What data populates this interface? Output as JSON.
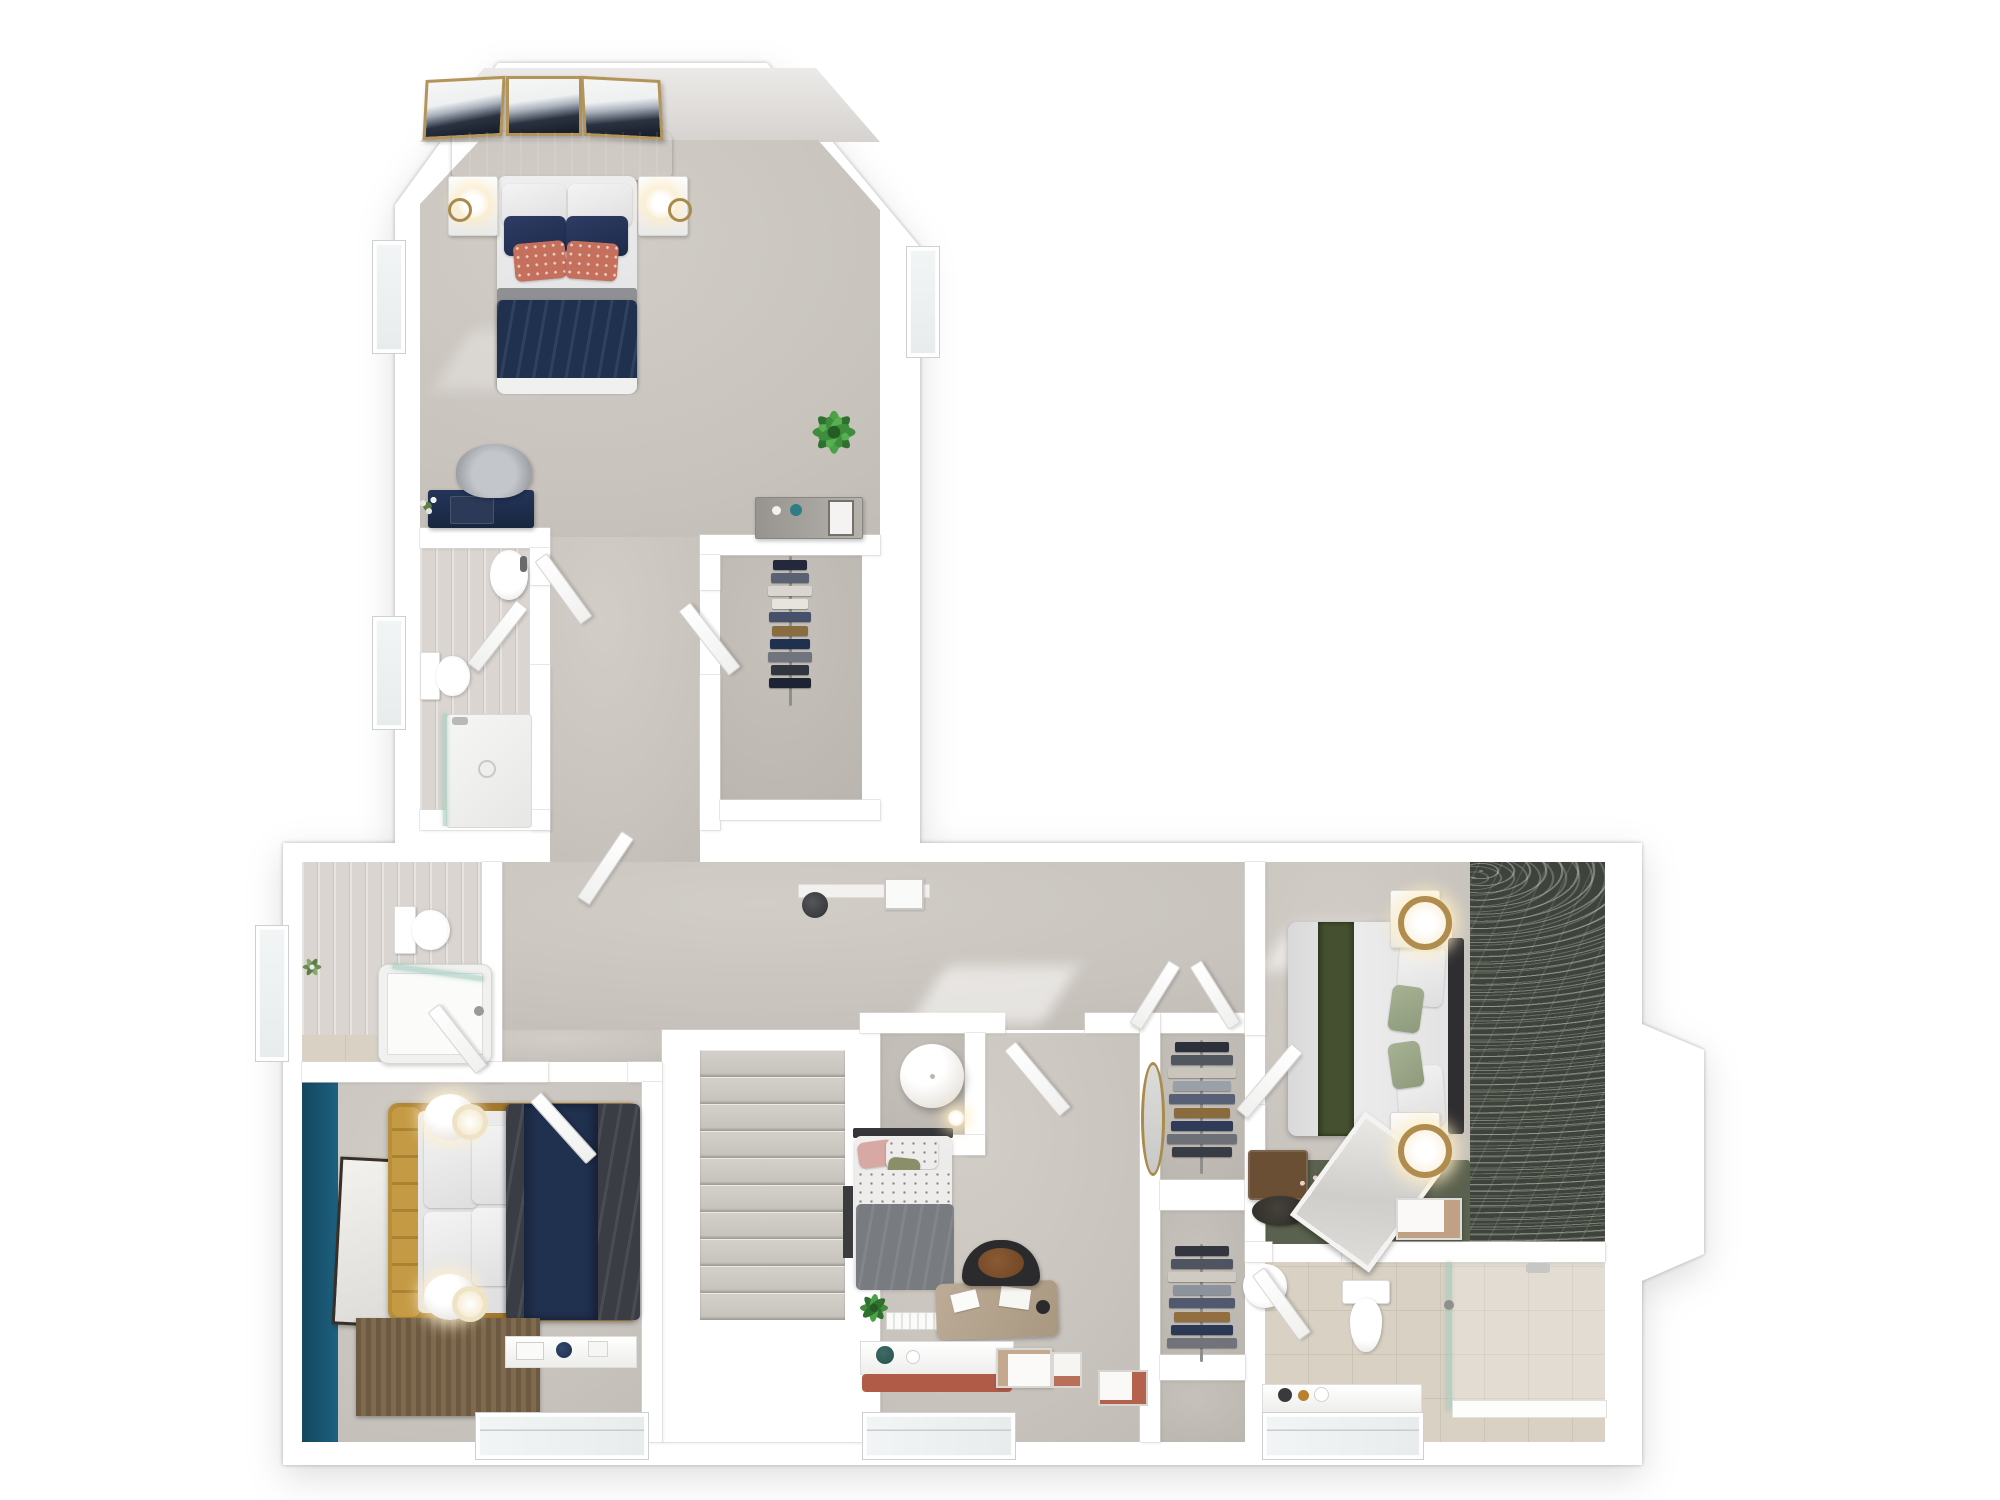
{
  "scene": {
    "type": "3d-floorplan-render",
    "view": "top-down dollhouse",
    "background": "#ffffff",
    "rooms": [
      {
        "id": "master-bedroom",
        "features": [
          "double-bed",
          "three-wall-art-frames",
          "two-nightstands",
          "desk",
          "dresser",
          "houseplant"
        ]
      },
      {
        "id": "master-ensuite",
        "features": [
          "basin",
          "toilet",
          "walk-in-shower",
          "window"
        ]
      },
      {
        "id": "walk-in-wardrobe",
        "features": [
          "clothes-rail"
        ]
      },
      {
        "id": "landing",
        "features": [
          "staircase",
          "radiator",
          "shelf"
        ]
      },
      {
        "id": "family-bathroom",
        "features": [
          "toilet",
          "bathtub",
          "window",
          "plant"
        ]
      },
      {
        "id": "bedroom-teal",
        "features": [
          "double-bed-gold-frame",
          "accent-wall",
          "artwork",
          "two-pendant-lamps",
          "slatted-runner",
          "window-shelf"
        ]
      },
      {
        "id": "bedroom-single",
        "features": [
          "single-bed",
          "desk",
          "chair",
          "pendant-ball-lamp",
          "plant",
          "window-seat",
          "leaning-frames",
          "oval-mirror"
        ]
      },
      {
        "id": "built-in-wardrobes",
        "features": [
          "clothes-rail-upper",
          "clothes-rail-lower"
        ]
      },
      {
        "id": "bedroom-green",
        "features": [
          "double-bed",
          "green-runner",
          "botanical-wallpaper",
          "two-ring-lamps",
          "two-nightstands",
          "bench",
          "leaning-mirror",
          "area-rug"
        ]
      },
      {
        "id": "shower-ensuite",
        "features": [
          "toilet",
          "basin",
          "walk-in-shower",
          "window-shelf"
        ]
      }
    ]
  },
  "palette": {
    "wall": "#ffffff",
    "wall_edge": "#dad8d5",
    "carpet": "#c8c3bd",
    "wood_floor": "#dad5d0",
    "tile_floor": "#d8d1c4",
    "teal_accent_wall": "#1d5c77",
    "navy_bedding": "#20304f",
    "coral_cushion": "#c4705c",
    "gold_bed_frame": "#a87c2e",
    "charcoal_duvet": "#3a3d43",
    "grey_duvet": "#787b80",
    "olive_runner": "#44502f",
    "sage_cushion": "#9aa687",
    "dark_headboard": "#2e2e30",
    "botanical_wallpaper": "#3e443c",
    "green_rug": "#5a614e",
    "wood_bench": "#6b4f35",
    "brass": "#b08d4e",
    "plant_green": "#3e8d3c",
    "rust_cushion": "#b05a48",
    "stair_tread": "#cac5bf",
    "shower_glass": "#a8cfc2"
  },
  "counts": {
    "wall_art_frames_master": 3,
    "master_pillows": {
      "white": 2,
      "navy": 2,
      "coral": 2
    },
    "pendant_lamps_teal_bedroom": 2,
    "ring_lamps_green_bedroom": 2
  },
  "stairs": {
    "visible_treads": 10
  },
  "closets": {
    "master_rail": [
      "#23283b",
      "#5a6172",
      "#d9d6cf",
      "#e7e4dd",
      "#47506a",
      "#8a6c41",
      "#20304f",
      "#6f747e",
      "#303540",
      "#1d2332"
    ],
    "wardrobe_upper": [
      "#2c303b",
      "#52575f",
      "#c9c5bd",
      "#9aa0a8",
      "#586077",
      "#8a6b3e",
      "#2e3b59",
      "#6d7177",
      "#383c44"
    ],
    "wardrobe_lower": [
      "#33363f",
      "#4e5461",
      "#cfcbc2",
      "#8d939d",
      "#515970",
      "#916f40",
      "#2b3856",
      "#70747a"
    ]
  }
}
